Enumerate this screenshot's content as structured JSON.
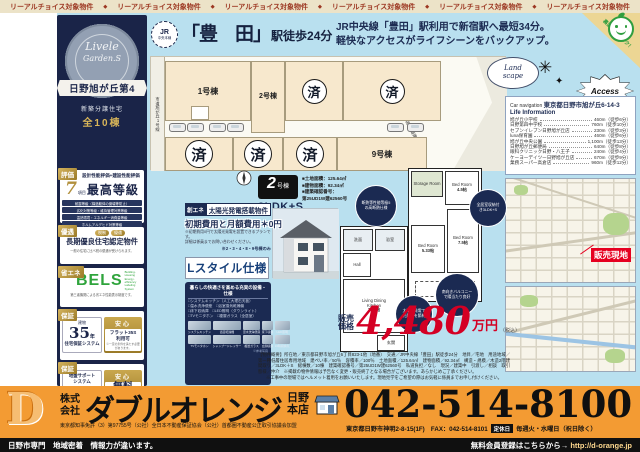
{
  "colors": {
    "navy": "#1b2a52",
    "light_blue": "#b9e0ef",
    "orange": "#f39b33",
    "price_red": "#d40024",
    "gold": "#b2903c",
    "bels_green": "#2fa43c",
    "sold_red": "#e60020"
  },
  "icons": {
    "jr_badge": "jr-line-badge",
    "smiley": "smiley-face",
    "compass": "compass",
    "sparkle": "✳",
    "sparkle_small": "✦",
    "storefront": "storefront",
    "car": "car"
  },
  "top_strip": {
    "label": "リーアルチョイス対象物件",
    "separator": "◆"
  },
  "left_panel": {
    "emblem": {
      "logo_top": "Livele",
      "logo_bottom": "Garden.S",
      "ribbon": "日野旭が丘第4",
      "sub": "新築分譲住宅",
      "total": "全10棟"
    },
    "badge1": {
      "tag": "評価",
      "heading": "設計性能評価+建設性能評価",
      "big_num": "7",
      "num_unit": "項目",
      "grade": "最高等級",
      "rows": [
        "耐震等級（構造躯体の倒壊等防止）",
        "劣化対策等級・維持管理対策等級",
        "温熱環境・エネルギー消費量等級",
        "ホルムアルデヒド対策等級"
      ]
    },
    "badge2": {
      "tag": "優遇",
      "chips": [
        "税制",
        "優遇"
      ],
      "heading": "長期優良住宅認定物件",
      "note": "一般の住宅に比べ税の優遇が受けられます。"
    },
    "badge3": {
      "tag": "省エネ",
      "logo": "BELS",
      "logo_sub": "Building-Housing Energy-efficiency Labeling System",
      "note": "第三者機関による省エネ性能表示制度です。"
    },
    "badge4": {
      "tag": "保証",
      "left_small": "建物",
      "left_num": "35",
      "left_unit": "年",
      "left_text": "住宅保証システム",
      "right_tag": "安心",
      "right_text1": "フラット35S",
      "right_text2": "利用可",
      "right_note": "※一定の条件を満たす必要があります。"
    },
    "badge5": {
      "tag": "保証",
      "left_text1": "地盤サポート",
      "left_text2": "システム",
      "left_num": "20",
      "left_unit": "年保証",
      "right_tag": "安心",
      "right_big": "無料",
      "right_text": "定期点検"
    }
  },
  "title": {
    "jr_line1": "JR",
    "jr_line2": "中央本線",
    "station_q": "「豊　田」",
    "station_suffix": "駅徒歩24分",
    "catch1": "JR中央線「豊田」駅利用で新宿駅へ最短34分。",
    "catch2": "軽快なアクセスがライフシーンをバックアップ。"
  },
  "curl": {
    "note": "裏面もチェック！"
  },
  "site_plan": {
    "road_left": "市道旭が丘1号線",
    "road_mid": "法42条1項2号道路",
    "lot1": "1号棟",
    "lot2": "2号棟",
    "lot9": "9号棟",
    "sold": "済"
  },
  "deco": {
    "cloud1": "Land",
    "cloud2": "scape",
    "access": "Access",
    "sparkle": "✳",
    "sparkle_small": "✦"
  },
  "info_card": {
    "nav_label": "Car navigation",
    "nav_value": "東京都日野市旭が丘6-14-3",
    "life_title": "Life Information",
    "items": [
      {
        "name": "旭が丘小学校",
        "dist": "460m（徒歩6分）"
      },
      {
        "name": "日野第四中学校",
        "dist": "760m（徒歩10分）"
      },
      {
        "name": "セブンイレブン日野旭が丘店",
        "dist": "230m（徒歩3分）"
      },
      {
        "name": "luna保育園",
        "dist": "460m（徒歩6分）"
      },
      {
        "name": "旭が丘中央公園",
        "dist": "1,100m（徒歩13分）"
      },
      {
        "name": "日野旭が丘郵便局",
        "dist": "640m（徒歩8分）"
      },
      {
        "name": "眼科クリニック日野・八王子",
        "dist": "240m（徒歩4分）"
      },
      {
        "name": "ケーヨーデイツー日野旭が丘店",
        "dist": "670m（徒歩9分）"
      },
      {
        "name": "業務スーパー高倉店",
        "dist": "960m（徒歩12分）"
      }
    ]
  },
  "map": {
    "label": "販売現地"
  },
  "unit": {
    "num": "2",
    "num_suffix": "号棟",
    "layout": "3LDK+S",
    "d1": "■土地面積：125.64㎡",
    "d2": "■建物面積：92.34㎡",
    "d3": "■建築確認番号：",
    "d4": "第25UD1W建62560号"
  },
  "solar": {
    "tag": "創エネ",
    "title": "太陽光発電搭載物件",
    "zero": "初期費用と月額費用＊0円",
    "note1": "※初期費用0円で太陽光発電を設置できるプランです。",
    "note2": "詳細は係員までお問い合わせください。",
    "only": "※2・3・4・8・9号棟のみ"
  },
  "lstyle": {
    "label": "Lスタイル仕様"
  },
  "equip": {
    "title": "暮らしの快適さを高める充実の設備・仕様",
    "bullets": [
      "□システムキッチン（人工大理石天板）",
      "□温水洗浄便座　□浴室換気乾燥機",
      "□床下収納庫　□LED照明（ダウンライト）",
      "□TVモニタホン　□複層ガラス（全居室）"
    ],
    "tiles": [
      "システムキッチン",
      "浴室乾燥機",
      "温水洗浄便座",
      "床下収納",
      "LED照明",
      "TVモニタホン",
      "シャンプードレッサー",
      "複層ガラス",
      "玄関収納",
      "24時間換気"
    ],
    "ref": "※参考写真"
  },
  "plans": {
    "compass": "N",
    "f2": {
      "storage": "Storage Room",
      "bed1": "Bed Room",
      "bed1_size": "4.5帖",
      "bed2": "Bed Room",
      "bed2_size": "5.33帖",
      "bed3": "Bed Room",
      "bed3_size": "7.5帖",
      "balcony": "Balcony"
    },
    "f1": {
      "powder": "洗面",
      "bath": "浴室",
      "hall": "Hall",
      "ldk1": "Living Dining",
      "ldk2": "Kitchen",
      "ldk_size": "16.0帖",
      "entrance": "玄関"
    }
  },
  "bubbles": {
    "b1": "断熱等性能等級5の高断熱仕様",
    "b2": "全居室収納付き3LDK+S",
    "b3": "南向きバルコニーで陽当たり良好",
    "b4": "太陽光発電で光熱費を節約"
  },
  "price": {
    "label1": "販売",
    "label2": "価格",
    "value": "4,480",
    "unit": "万円",
    "tax": "（税込）"
  },
  "fine_print": {
    "p1": "【物件概要】所在地／東京都日野市旭が丘6丁目823-1他（地番）　交通／JR中央線「豊田」駅徒歩24分　地目／宅地　用途地域／第一種低層住居専用地域　建ぺい率／50％　容積率／100％　土地面積／125.64㎡　建物面積／92.34㎡　構造・規模／木造2階建　間取り／3LDK＋S　総棟数／10棟　建築確認番号／第25UD1W建62560号　私道負担／なし　現況／建築中　引渡し／相談　取引態様／仲介　※掲載の物件情報は予告なく変更・販売終了となる場合がございます。あらかじめご了承ください。",
    "p2": "※工事中の現場ではヘルメット着用をお願いいたします。現地見学をご希望の際はお気軽に係員までお申し付けください。"
  },
  "company": {
    "kk1": "株式",
    "kk2": "会社",
    "name": "ダブルオレンジ",
    "branch1": "日野",
    "branch2": "本店",
    "license": "東京都知事免許（3）第97755号（公社）全日本不動産保証協会（公社）首都圏不動産公正取引協議会加盟",
    "tel": "042-514-8100",
    "addr": "東京都日野市神明2-8-15(1F)　FAX：042-514-8101",
    "holiday_tag": "定休日",
    "holiday": "毎週火・水曜日（祝日除く）"
  },
  "footer": {
    "left": "日野市専門　地域密着　情報力が違います。",
    "right_label": "無料会員登録はこちらから→",
    "url": "http://d-orange.jp"
  }
}
